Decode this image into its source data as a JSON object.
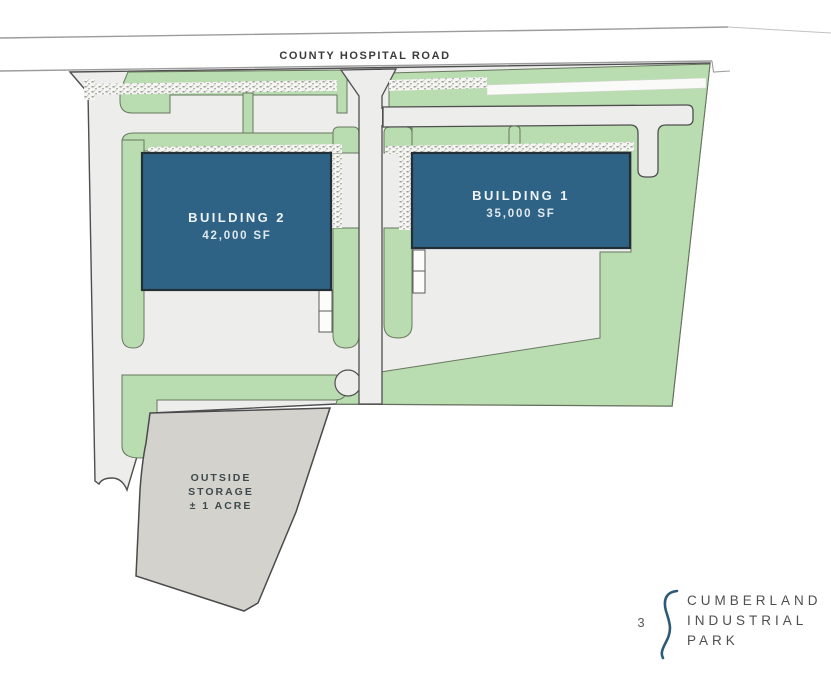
{
  "road": {
    "label": "COUNTY HOSPITAL ROAD"
  },
  "buildings": {
    "building1": {
      "label": "BUILDING 1",
      "area": "35,000 SF"
    },
    "building2": {
      "label": "BUILDING 2",
      "area": "42,000 SF"
    }
  },
  "storage": {
    "line1": "OUTSIDE",
    "line2": "STORAGE",
    "line3": "± 1 ACRE"
  },
  "footer_logo": {
    "page_number": "3",
    "name_line1": "CUMBERLAND",
    "name_line2": "INDUSTRIAL",
    "name_line3": "PARK"
  },
  "colors": {
    "building_fill": "#2f6386",
    "building_stroke": "#222f36",
    "landscape_green": "#b9dcb1",
    "landscape_stroke": "#68785f",
    "pavement": "#ededec",
    "pavement_stroke": "#4f4f4f",
    "storage_fill": "#d4d2cd",
    "storage_stroke": "#4a4a4a",
    "logo_mark": "#2d5a75"
  }
}
